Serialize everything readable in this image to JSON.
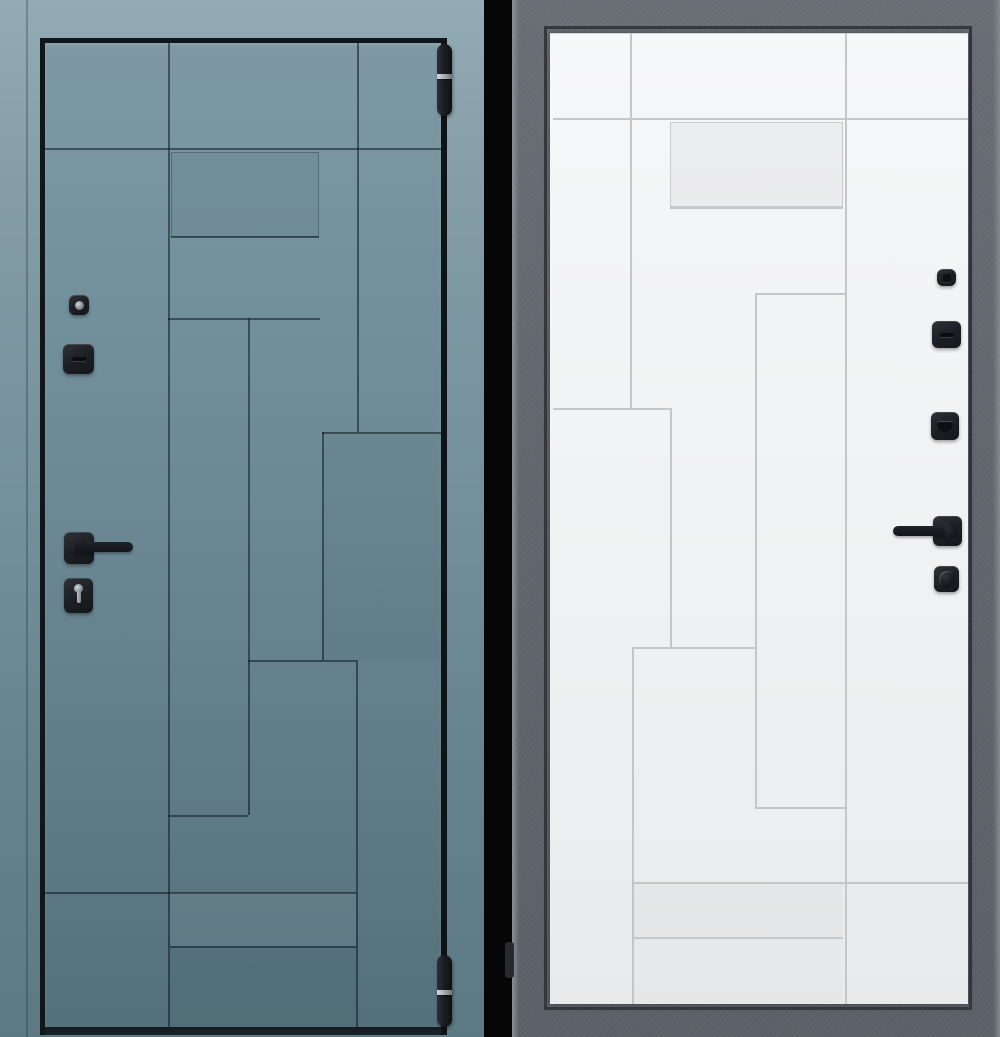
{
  "scene": {
    "description": "entrance-door-product-image-exterior-and-interior-views",
    "divider_color": "#060606",
    "left_view": {
      "side": "exterior",
      "colors": {
        "casing_top": "#93abb4",
        "casing_bottom": "#5d7a84",
        "leaf_top": "#7e99a4",
        "leaf_bottom": "#54707a",
        "edge": "#10161a",
        "seam": "rgba(14,26,32,0.55)",
        "hardware": "#1d2124",
        "metal": "#98a0a5"
      },
      "leaf_rect": [
        40,
        38,
        407,
        997
      ],
      "casing_seams": [
        [
          26,
          0,
          2,
          1037
        ]
      ],
      "seams": [
        [
          45,
          148,
          396,
          2
        ],
        [
          168,
          43,
          2,
          105
        ],
        [
          357,
          43,
          2,
          389
        ],
        [
          168,
          148,
          2,
          879
        ],
        [
          248,
          318,
          2,
          497
        ],
        [
          322,
          432,
          2,
          228
        ],
        [
          356,
          660,
          2,
          367
        ],
        [
          171,
          236,
          148,
          2
        ],
        [
          168,
          318,
          152,
          2
        ],
        [
          322,
          432,
          119,
          2
        ],
        [
          248,
          660,
          108,
          2
        ],
        [
          168,
          815,
          80,
          2
        ],
        [
          45,
          892,
          311,
          2
        ],
        [
          170,
          946,
          186,
          2
        ]
      ],
      "panels": [
        {
          "rect": [
            171,
            152,
            148,
            85
          ],
          "shade": "dark"
        },
        {
          "rect": [
            324,
            434,
            117,
            226
          ],
          "shade": "shade"
        },
        {
          "rect": [
            170,
            893,
            186,
            53
          ],
          "shade": "light"
        },
        {
          "rect": [
            170,
            948,
            186,
            79
          ],
          "shade": "shade"
        }
      ],
      "bottom_strip": [
        45,
        1027,
        396,
        8
      ],
      "hardware": [
        {
          "name": "peephole-viewer",
          "kind": "square",
          "rect": [
            69,
            295,
            20,
            20
          ],
          "glyph": "peep"
        },
        {
          "name": "lock-cylinder-cover",
          "kind": "square",
          "rect": [
            63,
            344,
            31,
            30
          ],
          "glyph": "slot"
        },
        {
          "name": "door-handle-rose",
          "kind": "square",
          "rect": [
            64,
            532,
            30,
            32
          ],
          "glyph": "boss"
        },
        {
          "name": "door-handle-lever",
          "kind": "lever",
          "rect": [
            74,
            542,
            59,
            10
          ],
          "dir": "right"
        },
        {
          "name": "key-cylinder-escutcheon",
          "kind": "square",
          "rect": [
            64,
            578,
            29,
            35
          ],
          "glyph": "keyhole"
        },
        {
          "name": "hinge-top",
          "kind": "hinge",
          "rect": [
            437,
            44,
            15,
            72
          ],
          "band": 30
        },
        {
          "name": "hinge-bottom",
          "kind": "hinge",
          "rect": [
            437,
            955,
            15,
            72
          ],
          "band": 35
        }
      ]
    },
    "right_view": {
      "side": "interior",
      "colors": {
        "frame": "#63676f",
        "frame_edge": "#8b8f96",
        "frame_recess": "#363a40",
        "leaf_top": "#f6f7f8",
        "leaf_bottom": "#e8eaec",
        "seam": "#c3c7c9",
        "hardware": "#1e2225",
        "metal": "#9aa1a6"
      },
      "leaf_rect": [
        550,
        33,
        418,
        971
      ],
      "seams": [
        [
          553,
          118,
          415,
          2
        ],
        [
          845,
          33,
          2,
          85
        ],
        [
          630,
          33,
          2,
          375
        ],
        [
          845,
          118,
          2,
          886
        ],
        [
          755,
          293,
          2,
          514
        ],
        [
          670,
          408,
          2,
          239
        ],
        [
          632,
          647,
          2,
          357
        ],
        [
          670,
          207,
          173,
          2
        ],
        [
          755,
          293,
          90,
          2
        ],
        [
          553,
          408,
          119,
          2
        ],
        [
          632,
          647,
          123,
          2
        ],
        [
          755,
          807,
          90,
          2
        ],
        [
          632,
          882,
          336,
          2
        ],
        [
          632,
          937,
          211,
          2
        ]
      ],
      "panels": [
        {
          "rect": [
            670,
            122,
            173,
            85
          ],
          "shade": "dark"
        },
        {
          "rect": [
            632,
            883,
            211,
            54
          ],
          "shade": "shade"
        },
        {
          "rect": [
            632,
            939,
            211,
            64
          ],
          "shade": "faint"
        }
      ],
      "hardware": [
        {
          "name": "privacy-latch-knob",
          "kind": "square",
          "rect": [
            937,
            269,
            19,
            17
          ],
          "glyph": "dot"
        },
        {
          "name": "lock-slot-cover",
          "kind": "square",
          "rect": [
            932,
            321,
            29,
            27
          ],
          "glyph": "slot"
        },
        {
          "name": "deadbolt-thumbturn",
          "kind": "square",
          "rect": [
            931,
            412,
            28,
            28
          ],
          "glyph": "thumbturn"
        },
        {
          "name": "door-handle-rose",
          "kind": "square",
          "rect": [
            933,
            516,
            29,
            30
          ],
          "glyph": "boss"
        },
        {
          "name": "door-handle-lever",
          "kind": "lever",
          "rect": [
            893,
            526,
            52,
            10
          ],
          "dir": "left"
        },
        {
          "name": "cylinder-thumb-knob",
          "kind": "square",
          "rect": [
            934,
            566,
            25,
            26
          ],
          "glyph": "knob"
        },
        {
          "name": "frame-hinge-cover",
          "kind": "tab",
          "rect": [
            505,
            942,
            9,
            36
          ]
        }
      ]
    }
  }
}
